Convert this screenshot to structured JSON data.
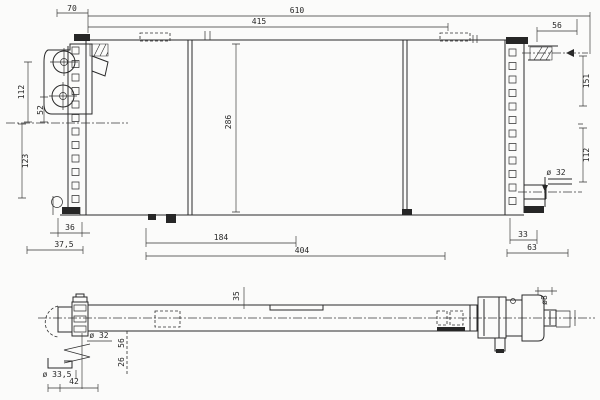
{
  "colors": {
    "paper": "#fbfbfa",
    "ink": "#262626"
  },
  "front_view": {
    "name": "radiator front elevation with header tanks and dimension annotations",
    "dims": {
      "top_offset": "70",
      "overall_width": "610",
      "upper_width": "415",
      "right_offset": "56",
      "left_height_upper": "112",
      "left_port_offset": "52",
      "left_height_lower": "123",
      "core_height": "286",
      "right_height_upper": "151",
      "right_height_lower": "112",
      "outlet_dia": "ø 32",
      "bottom_left_a": "36",
      "bottom_left_b": "37,5",
      "bottom_span_a": "184",
      "bottom_span_b": "404",
      "bottom_right_a": "33",
      "bottom_right_b": "63"
    }
  },
  "plan_view": {
    "name": "radiator top plan view with inlet, brackets and end fittings",
    "dims": {
      "inlet_dia": "ø 32",
      "depth_a": "56",
      "depth_b": "26",
      "bracket_width": "35",
      "hose_dia": "ø 33,5",
      "end_width": "42",
      "pin_dia": "ø8"
    }
  }
}
